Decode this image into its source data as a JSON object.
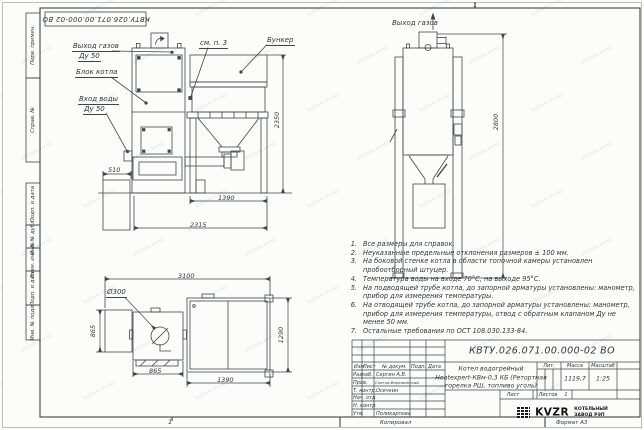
{
  "watermark": {
    "text": "kotlam.kv.kz"
  },
  "frame": {
    "zone_top": "1",
    "zone_bottom": "1"
  },
  "top_stamp": {
    "doc_number": "КВТУ.026.071.00.000-02 ВО"
  },
  "side_stamps": [
    {
      "label": "Перв. примен."
    },
    {
      "label": "Справ. №"
    },
    {
      "label": "Подп. и дата"
    },
    {
      "label": "Инв. № дубл."
    },
    {
      "label": "Взам. инв. №"
    },
    {
      "label": "Подп. и дата"
    },
    {
      "label": "Инв. № подл."
    }
  ],
  "front_view": {
    "labels": {
      "gas_outlet_line1": "Выход газов",
      "gas_outlet_line2": "Ду 50",
      "boiler_block": "Блок котла",
      "water_inlet_line1": "Вход воды",
      "water_inlet_line2": "Ду 50",
      "see_note": "см. п. 3",
      "hopper": "Бункер"
    },
    "dims": {
      "height": "2350",
      "left_box": "510",
      "hopper_width": "1390",
      "total_width": "2315"
    }
  },
  "side_view": {
    "labels": {
      "gas_outlet": "Выход газов"
    },
    "dims": {
      "height": "2800"
    }
  },
  "plan_view": {
    "dims": {
      "total_width": "3100",
      "hole_diameter": "Ø300",
      "left_depth": "865",
      "boiler_width": "865",
      "hopper_width": "1390",
      "hopper_depth": "1290"
    }
  },
  "notes": [
    {
      "num": "1.",
      "text": "Все размеры для справок."
    },
    {
      "num": "2.",
      "text": "Неуказанные предельные отклонения размеров ± 100 мм."
    },
    {
      "num": "3.",
      "text": "На боковой стенке котла в области топочной камеры установлен пробоотборный штуцер."
    },
    {
      "num": "4.",
      "text": "Температура воды на входе 70°С, на выходе 95°С."
    },
    {
      "num": "5.",
      "text": "На подводящей трубе котла, до запорной арматуры установлены: манометр, прибор для измерения температуры."
    },
    {
      "num": "6.",
      "text": "На отводящей трубе котла, до запорной арматуры установлены: манометр, прибор для измерения температуры, отвод с обратным клапаном Ду не менее 50 мм."
    },
    {
      "num": "7.",
      "text": "Остальные требования по ОСТ 108.030.133-84."
    }
  ],
  "title_block": {
    "doc_number": "КВТУ.026.071.00.000-02 ВО",
    "name_line1": "Котел водогрейный",
    "name_line2": "Heatexpert-КВм-0,3 КБ (Ретортная",
    "name_line3": "горелка РШ, топливо уголь)",
    "col_lit": "Лит.",
    "col_mass": "Масса",
    "col_scale": "Масштаб",
    "mass": "1119,7",
    "scale": "1:25",
    "sheet_label": "Лист",
    "sheets_label": "Листов",
    "sheets_value": "1",
    "rows": {
      "header": {
        "c1": "Изм",
        "c2": "Лист",
        "c3": "№ докум.",
        "c4": "Подп.",
        "c5": "Дата"
      },
      "developed": {
        "label": "Разраб.",
        "name": "Сергин А.В."
      },
      "checked": {
        "label": "Пров.",
        "name": "Снегов-Вережинский"
      },
      "tcontrol": {
        "label": "Т. контр.",
        "name": "Осечкин"
      },
      "dept": {
        "label": "Нач. отд.",
        "name": ""
      },
      "ncontrol": {
        "label": "Н. контр.",
        "name": ""
      },
      "approved": {
        "label": "Утв.",
        "name": "Поликарпова"
      }
    },
    "logo": {
      "mark_name": "kvzr-logo",
      "text": "KVZR",
      "line1": "КОТЕЛЬНЫЙ",
      "line2": "ЗАВОД РЭП"
    }
  },
  "footer": {
    "copied": "Копировал",
    "format": "Формат А3"
  }
}
